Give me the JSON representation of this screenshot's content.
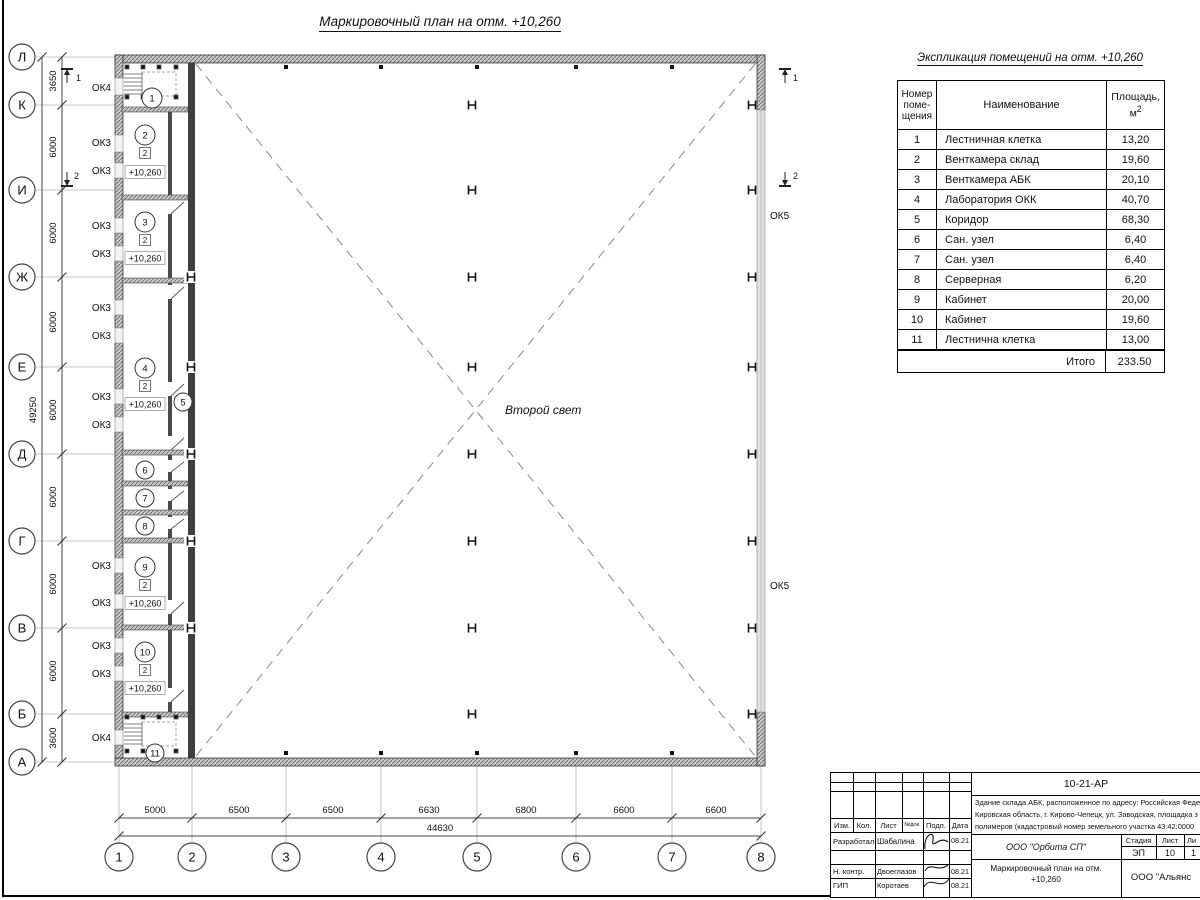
{
  "page": {
    "title": "Маркировочный план на отм. +10,260"
  },
  "explication": {
    "title": "Экспликация помещений на отм. +10,260",
    "col_number_l1": "Номер",
    "col_number_l2": "поме-",
    "col_number_l3": "щения",
    "col_name": "Наименование",
    "col_area_l1": "Площадь,",
    "col_area_l2": "м",
    "col_area_sup": "2",
    "rows": [
      {
        "n": "1",
        "name": "Лестничная клетка",
        "area": "13,20"
      },
      {
        "n": "2",
        "name": "Венткамера склад",
        "area": "19,60"
      },
      {
        "n": "3",
        "name": "Венткамера АБК",
        "area": "20,10"
      },
      {
        "n": "4",
        "name": "Лаборатория ОКК",
        "area": "40,70"
      },
      {
        "n": "5",
        "name": "Коридор",
        "area": "68,30"
      },
      {
        "n": "6",
        "name": "Сан. узел",
        "area": "6,40"
      },
      {
        "n": "7",
        "name": "Сан. узел",
        "area": "6,40"
      },
      {
        "n": "8",
        "name": "Серверная",
        "area": "6,20"
      },
      {
        "n": "9",
        "name": "Кабинет",
        "area": "20,00"
      },
      {
        "n": "10",
        "name": "Кабинет",
        "area": "19,60"
      },
      {
        "n": "11",
        "name": "Лестнична клетка",
        "area": "13,00"
      }
    ],
    "total_label": "Итого",
    "total_value": "233.50"
  },
  "axes": {
    "rows": [
      "Л",
      "К",
      "И",
      "Ж",
      "Е",
      "Д",
      "Г",
      "В",
      "Б",
      "А"
    ],
    "row_dims": [
      "3650",
      "6000",
      "6000",
      "6000",
      "6000",
      "6000",
      "6000",
      "6000",
      "3600"
    ],
    "row_total": "49250",
    "cols": [
      "1",
      "2",
      "3",
      "4",
      "5",
      "6",
      "7",
      "8"
    ],
    "col_dims": [
      "5000",
      "6500",
      "6500",
      "6630",
      "6800",
      "6600",
      "6600"
    ],
    "col_total": "44630"
  },
  "plan": {
    "second_light": "Второй свет",
    "section_mark_1": "1",
    "section_mark_2": "2",
    "left_windows": [
      "ОК4",
      "ОК3",
      "ОК3",
      "ОК3",
      "ОК3",
      "ОК3",
      "ОК3",
      "ОК3",
      "ОК3",
      "ОК3",
      "ОК3",
      "ОК3",
      "ОК3",
      "ОК4"
    ],
    "right_windows": [
      "ОК5",
      "ОК5"
    ],
    "rooms": [
      {
        "num": "1"
      },
      {
        "num": "2",
        "type": "2",
        "elev": "+10,260"
      },
      {
        "num": "3",
        "type": "2",
        "elev": "+10,260"
      },
      {
        "num": "4",
        "type": "2",
        "elev": "+10,260"
      },
      {
        "num": "5"
      },
      {
        "num": "6"
      },
      {
        "num": "7"
      },
      {
        "num": "8"
      },
      {
        "num": "9",
        "type": "2",
        "elev": "+10,260"
      },
      {
        "num": "10",
        "type": "2",
        "elev": "+10,260"
      },
      {
        "num": "11"
      }
    ]
  },
  "titleblock": {
    "doc_number": "10-21-АР",
    "desc_line1": "Здание склада АБК, расположенное по адресу: Российская Феде",
    "desc_line2": "Кировская область, г. Кирово-Чепецк, ул. Заводская, площадка з",
    "desc_line3": "полимеров (кадастровый номер земельного участка 43:42:0000",
    "header": {
      "izm": "Изм.",
      "kol": "Кол.",
      "list": "Лист",
      "ndok": "№док.",
      "podp": "Подп.",
      "data": "Дата"
    },
    "sign_rows": [
      {
        "role": "Разработал",
        "name": "Шабалина",
        "date": "08.21"
      },
      {
        "role": "Н. контр.",
        "name": "Двоеглазов",
        "date": "08.21"
      },
      {
        "role": "ГИП",
        "name": "Коротаев",
        "date": "08.21"
      }
    ],
    "company": "ООО \"Орбита СП\"",
    "stage_label": "Стадия",
    "sheet_label": "Лист",
    "sheets_label": "Ли",
    "stage": "ЭП",
    "sheet": "10",
    "sheets": "1",
    "drawing_title_l1": "Маркировочный план на отм.",
    "drawing_title_l2": "+10,260",
    "company2": "ООО \"Альянс"
  }
}
